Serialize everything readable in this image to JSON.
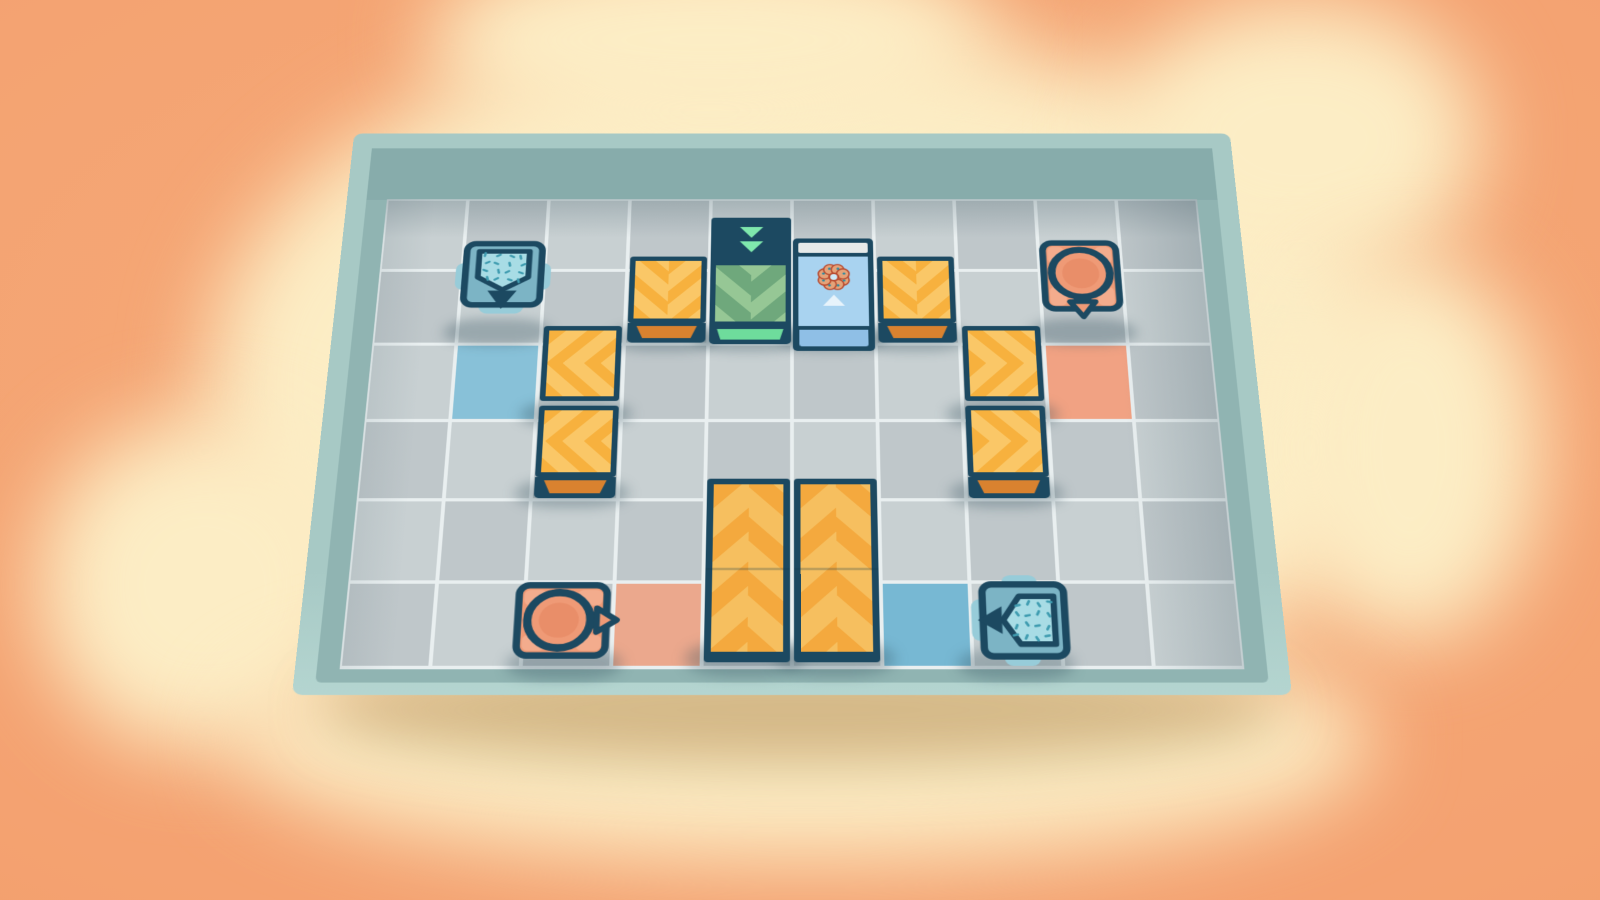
{
  "scene": {
    "description": "top-down puzzle room on clouds",
    "board": {
      "cols": 10,
      "rows": 6
    }
  },
  "palette": {
    "bg_orange": "#f4a673",
    "cloud_cream": "#fcedc5",
    "under_board_shadow": "rgba(163,120,60,0.45)",
    "wall_rim": "#a7c9c5",
    "wall_rim_bottom": "#b4d5d0",
    "wall_bevel": "#90b4b2",
    "wall_bevel_top": "#87acab",
    "floor_line": "#e9eff0",
    "cell_light": "#c8d0d2",
    "cell_dark": "#bfc7ca",
    "frame": "#1c4961",
    "crate_base": "#f7b13e",
    "crate_stripe": "#fac767",
    "crate_front": "#d9822f",
    "tall_base": "#f4a93e",
    "tall_stripe": "#f6bf5f",
    "gate_face": "#96c795",
    "gate_stripe": "#6fa87c",
    "gate_front": "#6edc9c",
    "gate_arrow": "#7fe8ad",
    "donut_face": "#a9d3f0",
    "donut_front": "#8fbfe6",
    "donut_slot": "#e7eae9",
    "donut_petal": "#e5a379",
    "donut_outline": "#b8492e",
    "donut_dot": "#2f8aa0",
    "donut_hole": "#cfe9f7",
    "sprinkle_body": "#7cb4c5",
    "sprinkle_light": "#97ccd9",
    "sprinkle_fill": "#a8dce5",
    "sprinkle_bits": "#3f9cb0",
    "frosting_body": "#ef9a76",
    "frosting_light": "#f3ac8d",
    "frosting_inner": "#e98e69",
    "entity_shadow": "rgba(45,75,90,0.30)",
    "goal_blue": "#88c1d8",
    "goal_blue_bottom": "#77b8d3",
    "goal_peach": "#f1a283",
    "goal_peach_bottom": "#eba88d"
  },
  "goal_cells": [
    {
      "col": 2,
      "row": 3,
      "color_key": "goal_blue"
    },
    {
      "col": 9,
      "row": 3,
      "color_key": "goal_peach"
    },
    {
      "col": 4,
      "row": 6,
      "color_key": "goal_peach_bottom"
    },
    {
      "col": 7,
      "row": 6,
      "color_key": "goal_blue_bottom"
    }
  ],
  "entities": [
    {
      "type": "sprinkle_machine",
      "dir": "down",
      "col": 2,
      "row": 2
    },
    {
      "type": "crate",
      "dir": "down",
      "col": 4,
      "row": 2,
      "front": true
    },
    {
      "type": "green_gate",
      "dir": "down",
      "col": 5,
      "row": 2
    },
    {
      "type": "donut_tile",
      "dir": "up",
      "col": 6,
      "row": 2
    },
    {
      "type": "crate",
      "dir": "down",
      "col": 7,
      "row": 2,
      "front": true
    },
    {
      "type": "frosting_machine",
      "dir": "down",
      "col": 9,
      "row": 2
    },
    {
      "type": "crate",
      "dir": "left",
      "col": 3,
      "row": 3,
      "front": false
    },
    {
      "type": "crate",
      "dir": "left",
      "col": 3,
      "row": 4,
      "front": true
    },
    {
      "type": "crate",
      "dir": "right",
      "col": 8,
      "row": 3,
      "front": false
    },
    {
      "type": "crate",
      "dir": "right",
      "col": 8,
      "row": 4,
      "front": true
    },
    {
      "type": "tall_crate",
      "dir": "up",
      "col": 5,
      "row": 5,
      "span_rows": 2
    },
    {
      "type": "tall_crate",
      "dir": "up",
      "col": 6,
      "row": 5,
      "span_rows": 2
    },
    {
      "type": "frosting_machine",
      "dir": "right",
      "col": 3,
      "row": 6
    },
    {
      "type": "sprinkle_machine",
      "dir": "left",
      "col": 8,
      "row": 6
    }
  ],
  "icons": {
    "donut": "donut-icon",
    "gate_arrows": "double-down-arrows-icon",
    "flow_arrow": "up-arrow-icon",
    "sprinkle_hopper": "sprinkle-hopper-icon",
    "frosting_tank": "frosting-tank-icon",
    "spout": "spout-triangle-icon"
  }
}
